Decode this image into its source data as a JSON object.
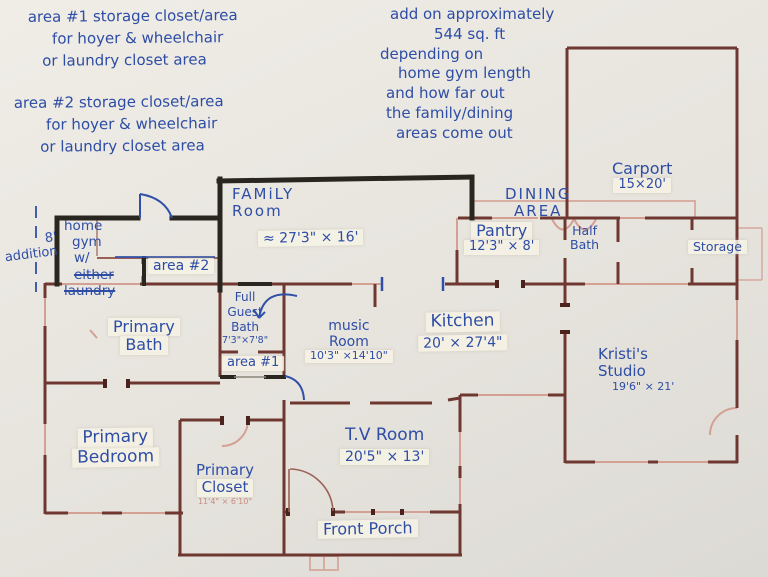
{
  "colors": {
    "paper": "#e9e6e0",
    "wall_printed": "#6e3831",
    "wall_light_pink": "#d4a094",
    "marker_black": "#29261f",
    "pen_blue": "#3050a8"
  },
  "notes": {
    "area1_note": {
      "lines": [
        "area #1 storage closet/area",
        "for hoyer & wheelchair",
        "or laundry closet area"
      ]
    },
    "area2_note": {
      "lines": [
        "area #2 storage closet/area",
        "for hoyer & wheelchair",
        "or laundry closet area"
      ]
    },
    "addon_note": {
      "lines": [
        "add on approximately",
        "544 sq. ft",
        "depending on",
        "home gym length",
        "and how far out",
        "the family/dining",
        "areas come out"
      ]
    },
    "addition_label": {
      "lines": [
        "8'",
        "addition"
      ]
    }
  },
  "rooms": {
    "carport": {
      "name": "Carport",
      "dims": "15×20'"
    },
    "family_room": {
      "lines": [
        "FAMiLY",
        "Room"
      ]
    },
    "dining_area": {
      "lines": [
        "DINING",
        "AREA"
      ]
    },
    "family_dining_dims": "≈ 27'3\" × 16'",
    "home_gym": {
      "line1": "home",
      "line2": "gym",
      "line3_prefix": "w/",
      "line3_struck": "either",
      "line4_struck": "laundry"
    },
    "area2": {
      "label": "area #2"
    },
    "pantry": {
      "name": "Pantry",
      "dims": "12'3\" × 8'"
    },
    "half_bath": {
      "lines": [
        "Half",
        "Bath"
      ]
    },
    "storage": {
      "name": "Storage"
    },
    "full_guest_bath": {
      "lines": [
        "Full",
        "Guest",
        "Bath"
      ],
      "dims": "7'3\"×7'8\""
    },
    "area1": {
      "label": "area #1"
    },
    "music_room": {
      "lines": [
        "music",
        "Room"
      ],
      "dims": "10'3\" ×14'10\""
    },
    "kitchen": {
      "name": "Kitchen",
      "dims": "20' × 27'4\""
    },
    "kristis_studio": {
      "lines": [
        "Kristi's",
        "Studio"
      ],
      "dims": "19'6\" × 21'"
    },
    "primary_bath": {
      "lines": [
        "Primary",
        "Bath"
      ]
    },
    "primary_bedroom": {
      "lines": [
        "Primary",
        "Bedroom"
      ]
    },
    "primary_closet": {
      "lines": [
        "Primary",
        "Closet"
      ],
      "printed_dims": "11'4\" × 6'10\""
    },
    "tv_room": {
      "name": "T.V Room",
      "dims": "20'5\" × 13'"
    },
    "front_porch": {
      "name": "Front Porch"
    }
  }
}
